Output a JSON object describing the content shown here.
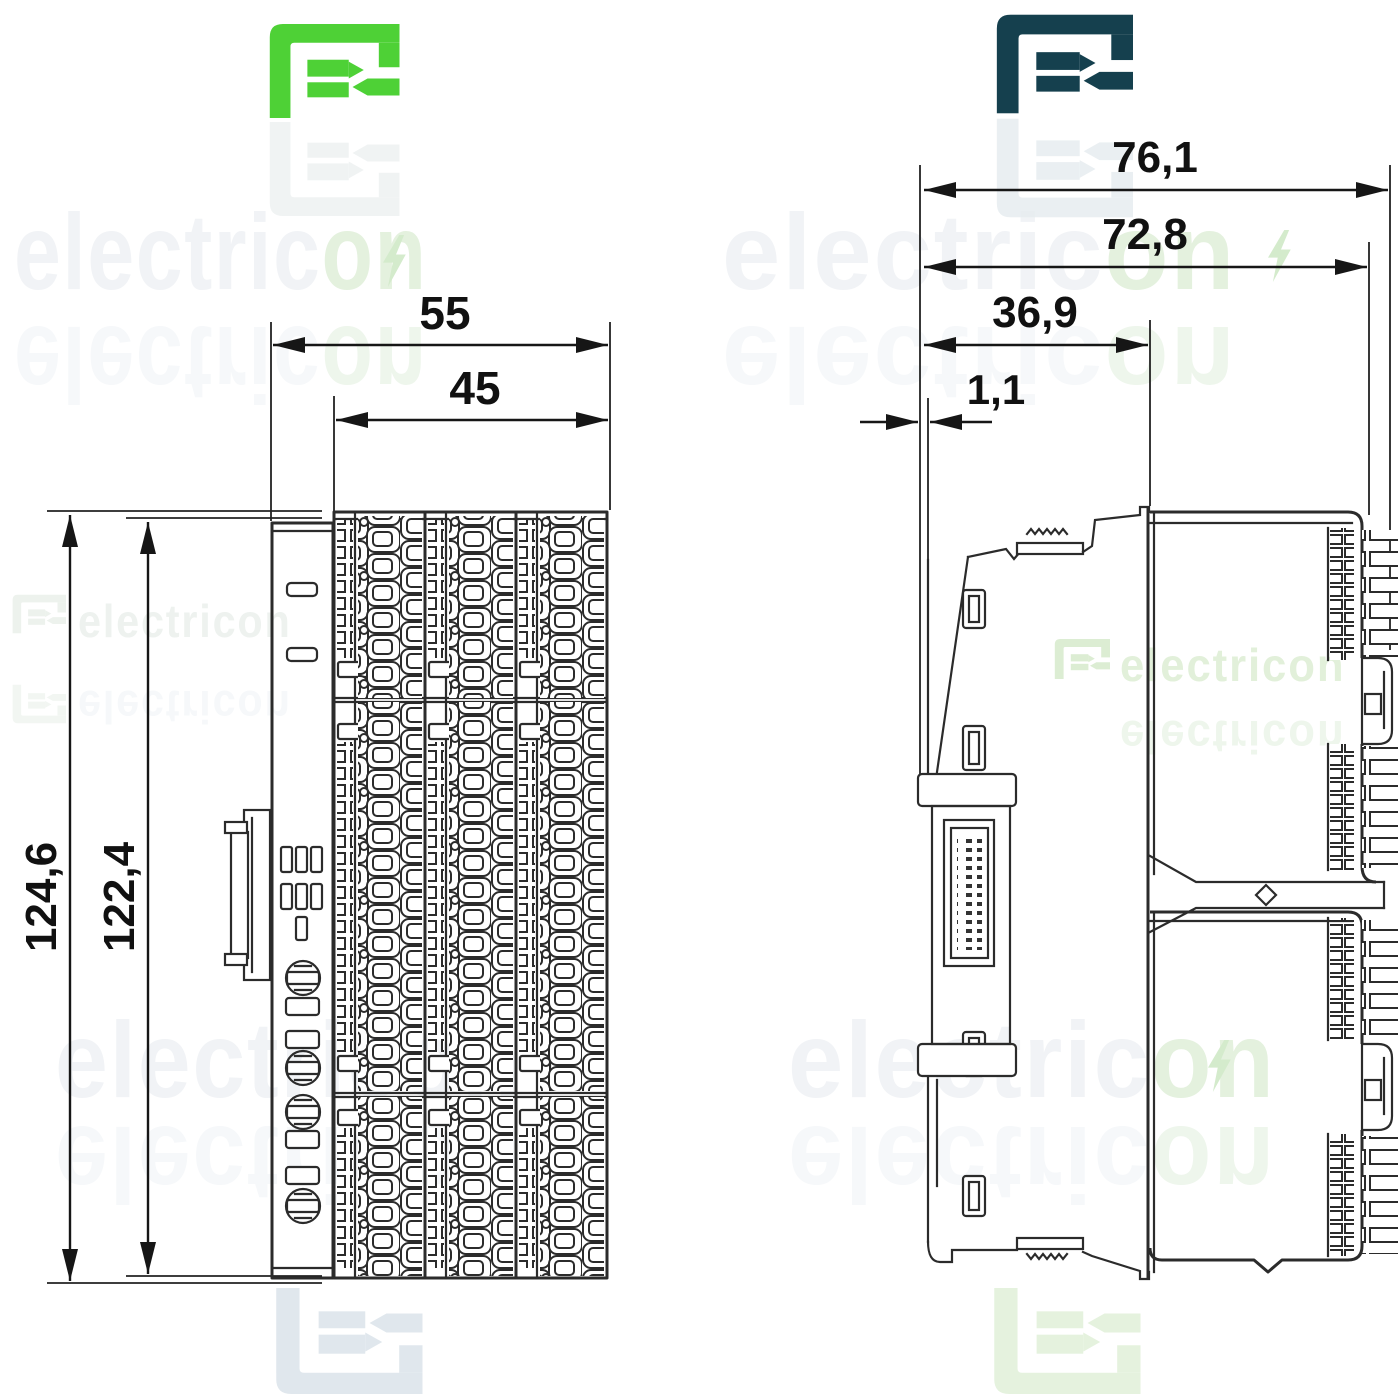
{
  "page": {
    "background": "#ffffff",
    "line_color": "#2b2b2b",
    "dimension_text_color": "#111111"
  },
  "branding": {
    "watermark_text": "electricon",
    "watermark_prefix": "electric",
    "watermark_suffix": "on",
    "logo_green_color": "#4ed136",
    "logo_navy_color": "#15404e",
    "watermark_gray": "#f1f3f6",
    "watermark_green": "#e4f1de",
    "logo_icon": "electricon-e-arrow-logo",
    "bolt_icon": "lightning-bolt-in-o"
  },
  "front_view": {
    "name": "module front view drawing",
    "dim_width_outer": "55",
    "dim_width_inner": "45",
    "dim_height_outer": "124,6",
    "dim_height_inner": "122,4"
  },
  "side_view": {
    "name": "module side view drawing",
    "dim_depth_outer": "76,1",
    "dim_depth_body": "72,8",
    "dim_depth_front": "36,9",
    "dim_offset_rear": "1,1"
  }
}
